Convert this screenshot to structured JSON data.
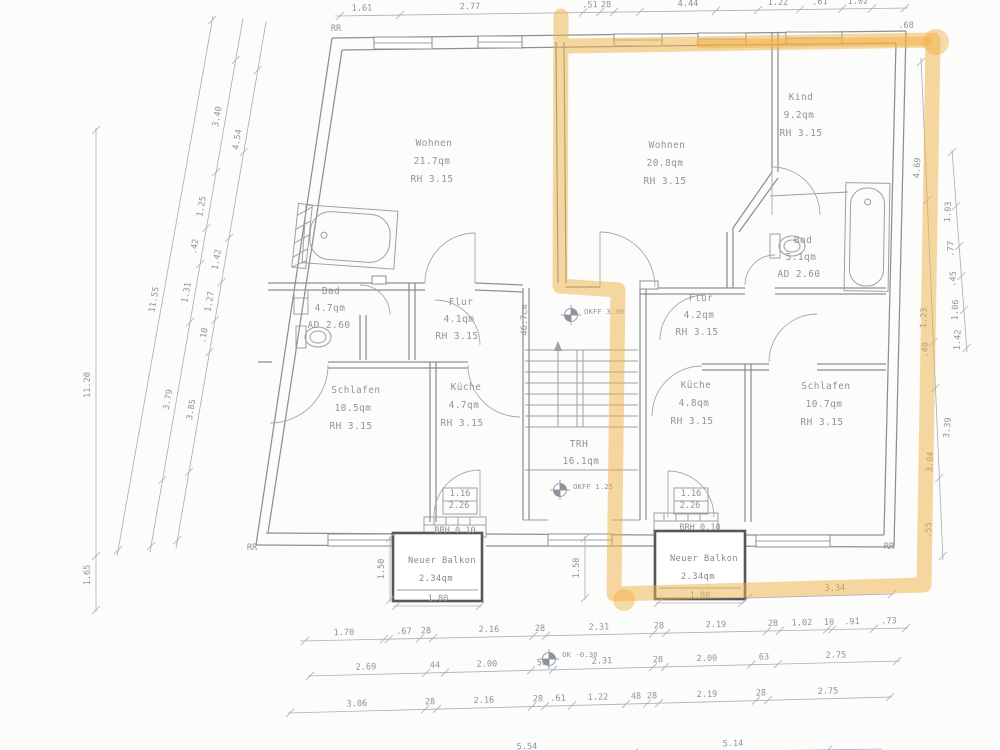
{
  "markers": {
    "upper": "OKFF 3.30",
    "mid": "OKFF 1.25",
    "ground": "OK -0.30"
  },
  "rooms": [
    {
      "name": "Wohnen",
      "area": "21.7qm",
      "height": "RH 3.15"
    },
    {
      "name": "Wohnen",
      "area": "20.8qm",
      "height": "RH 3.15"
    },
    {
      "name": "Kind",
      "area": "9.2qm",
      "height": "RH 3.15"
    },
    {
      "name": "Bad",
      "area": "4.7qm",
      "height": "AD 2.60"
    },
    {
      "name": "Flur",
      "area": "4.1qm",
      "height": "RH 3.15"
    },
    {
      "name": "Flur",
      "area": "4.2qm",
      "height": "RH 3.15"
    },
    {
      "name": "Bad",
      "area": "5.1qm",
      "height": "AD 2.60"
    },
    {
      "name": "Schlafen",
      "area": "10.5qm",
      "height": "RH 3.15"
    },
    {
      "name": "Küche",
      "area": "4.7qm",
      "height": "RH 3.15"
    },
    {
      "name": "Küche",
      "area": "4.8qm",
      "height": "RH 3.15"
    },
    {
      "name": "Schlafen",
      "area": "10.7qm",
      "height": "RH 3.15"
    },
    {
      "name": "TRH",
      "area": "16.1qm"
    },
    {
      "name": "Neuer Balkon",
      "area": "2.34qm"
    },
    {
      "name": "Neuer Balkon",
      "area": "2.34qm"
    }
  ],
  "highlight_color": "#efb044",
  "annotations": [
    {
      "t": "RR",
      "x": 336,
      "y": 31
    },
    {
      "t": "RR",
      "x": 252,
      "y": 550
    },
    {
      "t": "RR",
      "x": 889,
      "y": 549
    },
    {
      "t": ".68",
      "x": 906,
      "y": 28,
      "s": 7
    },
    {
      "t": "1.16",
      "x": 460,
      "y": 496,
      "s": 7.5
    },
    {
      "t": "2.26",
      "x": 459,
      "y": 508,
      "s": 7.5
    },
    {
      "t": "1.16",
      "x": 691,
      "y": 496,
      "s": 7.5
    },
    {
      "t": "2.26",
      "x": 690,
      "y": 508,
      "s": 7.5
    },
    {
      "t": "BRH 0.10",
      "x": 455,
      "y": 533,
      "s": 7
    },
    {
      "t": "BRH 0.10",
      "x": 700,
      "y": 530,
      "s": 7
    },
    {
      "t": ".55",
      "x": 931,
      "y": 530,
      "r": -88,
      "s": 7.5
    },
    {
      "t": "3.39",
      "x": 950,
      "y": 428,
      "r": -85
    },
    {
      "t": "46.7cm",
      "x": 527,
      "y": 320,
      "r": -90,
      "s": 6.5
    }
  ],
  "chains": [
    {
      "x1": 300,
      "y1": 641,
      "x2": 908,
      "y2": 628,
      "axis": "x",
      "lrot": -1.2,
      "ticks": [
        305,
        384,
        389,
        420,
        433,
        533,
        546,
        653,
        666,
        767,
        780,
        827,
        832,
        874,
        906
      ],
      "labels": [
        {
          "t": "1.70",
          "p": 344
        },
        {
          "t": ".67",
          "p": 404
        },
        {
          "t": "28",
          "p": 426,
          "s": 7
        },
        {
          "t": "2.16",
          "p": 489
        },
        {
          "t": "28",
          "p": 540,
          "s": 7
        },
        {
          "t": "2.31",
          "p": 599
        },
        {
          "t": "28",
          "p": 659,
          "s": 7
        },
        {
          "t": "2.19",
          "p": 716
        },
        {
          "t": "28",
          "p": 773,
          "s": 7
        },
        {
          "t": "1.02",
          "p": 802
        },
        {
          "t": "10",
          "p": 829,
          "s": 7
        },
        {
          "t": ".91",
          "p": 852
        },
        {
          "t": ".73",
          "p": 889
        }
      ]
    },
    {
      "x1": 308,
      "y1": 676,
      "x2": 900,
      "y2": 661,
      "axis": "x",
      "lrot": -1.4,
      "ticks": [
        310,
        426,
        445,
        531,
        553,
        653,
        665,
        751,
        778,
        897
      ],
      "labels": [
        {
          "t": "2.69",
          "p": 366
        },
        {
          "t": "44",
          "p": 435,
          "s": 7
        },
        {
          "t": "2.00",
          "p": 487
        },
        {
          "t": "50",
          "p": 542,
          "s": 7
        },
        {
          "t": "2.31",
          "p": 602
        },
        {
          "t": "28",
          "p": 658,
          "s": 7
        },
        {
          "t": "2.00",
          "p": 707
        },
        {
          "t": "63",
          "p": 764,
          "s": 7
        },
        {
          "t": "2.75",
          "p": 836
        }
      ]
    },
    {
      "x1": 288,
      "y1": 713,
      "x2": 892,
      "y2": 697,
      "axis": "x",
      "lrot": -1.5,
      "ticks": [
        290,
        425,
        437,
        532,
        545,
        572,
        626,
        647,
        659,
        756,
        768,
        890
      ],
      "labels": [
        {
          "t": "3.06",
          "p": 357
        },
        {
          "t": "28",
          "p": 430,
          "s": 7
        },
        {
          "t": "2.16",
          "p": 484
        },
        {
          "t": "28",
          "p": 538,
          "s": 7
        },
        {
          "t": ".61",
          "p": 558
        },
        {
          "t": "1.22",
          "p": 598
        },
        {
          "t": "48",
          "p": 636,
          "s": 7
        },
        {
          "t": "28",
          "p": 652,
          "s": 7
        },
        {
          "t": "2.19",
          "p": 707
        },
        {
          "t": "28",
          "p": 761,
          "s": 7
        },
        {
          "t": "2.75",
          "p": 828
        }
      ]
    },
    {
      "x1": 395,
      "y1": 756,
      "x2": 882,
      "y2": 749,
      "axis": "x",
      "lrot": -1,
      "ticks": [
        420,
        634,
        828
      ],
      "labels": [
        {
          "t": "5.54",
          "p": 527
        },
        {
          "t": "5.14",
          "p": 733
        }
      ]
    },
    {
      "x1": 335,
      "y1": 16,
      "x2": 908,
      "y2": 8,
      "axis": "x",
      "lrot": -1,
      "ticks": [
        340,
        400,
        583,
        600,
        614,
        640,
        716,
        758,
        800,
        842,
        872,
        905
      ],
      "labels": [
        {
          "t": "1.61",
          "p": 362
        },
        {
          "t": "2.77",
          "p": 470
        },
        {
          "t": ".51",
          "p": 590
        },
        {
          "t": "28",
          "p": 606,
          "s": 7
        },
        {
          "t": "4.44",
          "p": 688
        },
        {
          "t": "1.22",
          "p": 778
        },
        {
          "t": ".61",
          "p": 820
        },
        {
          "t": "1.02",
          "p": 858
        }
      ]
    },
    {
      "x1": 96,
      "y1": 128,
      "x2": 96,
      "y2": 612,
      "axis": "y",
      "lrot": -90,
      "ticks": [
        130,
        556,
        610
      ],
      "labels": [
        {
          "t": "11.20",
          "p": 385
        },
        {
          "t": "1.65",
          "p": 575
        }
      ]
    },
    {
      "x1": 213,
      "y1": 16,
      "x2": 117,
      "y2": 556,
      "axis": "y",
      "lrot": -80,
      "ticks": [
        20,
        550
      ],
      "labels": [
        {
          "t": "11.55",
          "p": 300
        }
      ]
    },
    {
      "x1": 243,
      "y1": 18,
      "x2": 150,
      "y2": 552,
      "axis": "y",
      "lrot": -80,
      "ticks": [
        60,
        172,
        228,
        264,
        322,
        480,
        546
      ],
      "labels": [
        {
          "t": "3.40",
          "p": 117
        },
        {
          "t": "1.25",
          "p": 207
        },
        {
          "t": ".42",
          "p": 247,
          "s": 7
        },
        {
          "t": "1.31",
          "p": 293
        },
        {
          "t": "3.79",
          "p": 400
        }
      ]
    },
    {
      "x1": 266,
      "y1": 22,
      "x2": 176,
      "y2": 548,
      "axis": "y",
      "lrot": -80,
      "ticks": [
        70,
        152,
        238,
        282,
        320,
        352,
        472,
        540
      ],
      "labels": [
        {
          "t": "4.54",
          "p": 140
        },
        {
          "t": "1.42",
          "p": 260
        },
        {
          "t": "1.27",
          "p": 302
        },
        {
          "t": ".10",
          "p": 336,
          "s": 7
        },
        {
          "t": "3.85",
          "p": 410
        }
      ]
    },
    {
      "x1": 921,
      "y1": 58,
      "x2": 943,
      "y2": 560,
      "axis": "y",
      "lrot": -87,
      "ticks": [
        62,
        200,
        342,
        388,
        478,
        556
      ],
      "labels": [
        {
          "t": "4.69",
          "p": 168
        },
        {
          "t": "1.23",
          "p": 318
        },
        {
          "t": ".49",
          "p": 350,
          "s": 7
        },
        {
          "t": "3.04",
          "p": 462
        }
      ]
    },
    {
      "x1": 952,
      "y1": 150,
      "x2": 967,
      "y2": 352,
      "axis": "y",
      "lrot": -87,
      "ticks": [
        152,
        206,
        246,
        276,
        310,
        348
      ],
      "labels": [
        {
          "t": "1.03",
          "p": 212
        },
        {
          "t": ".77",
          "p": 249
        },
        {
          "t": ".45",
          "p": 279,
          "s": 7
        },
        {
          "t": "1.06",
          "p": 310
        },
        {
          "t": "1.42",
          "p": 340
        }
      ]
    },
    {
      "x1": 390,
      "y1": 536,
      "x2": 390,
      "y2": 602,
      "axis": "y",
      "lrot": -90,
      "ticks": [
        538,
        600
      ],
      "labels": [
        {
          "t": "1.50",
          "p": 569
        }
      ]
    },
    {
      "x1": 585,
      "y1": 536,
      "x2": 585,
      "y2": 600,
      "axis": "y",
      "lrot": -90,
      "ticks": [
        538,
        598
      ],
      "labels": [
        {
          "t": "1.50",
          "p": 568
        }
      ]
    },
    {
      "x1": 394,
      "y1": 606,
      "x2": 482,
      "y2": 606,
      "axis": "x",
      "lrot": 0,
      "ticks": [
        396,
        480
      ],
      "labels": [
        {
          "t": "1.80",
          "p": 438
        }
      ]
    },
    {
      "x1": 656,
      "y1": 603,
      "x2": 744,
      "y2": 603,
      "axis": "x",
      "lrot": 0,
      "ticks": [
        658,
        742
      ],
      "labels": [
        {
          "t": "1.80",
          "p": 700
        }
      ]
    },
    {
      "x1": 746,
      "y1": 598,
      "x2": 894,
      "y2": 594,
      "axis": "x",
      "lrot": -1,
      "ticks": [
        748,
        892
      ],
      "labels": [
        {
          "t": "3.34",
          "p": 835
        }
      ]
    }
  ]
}
